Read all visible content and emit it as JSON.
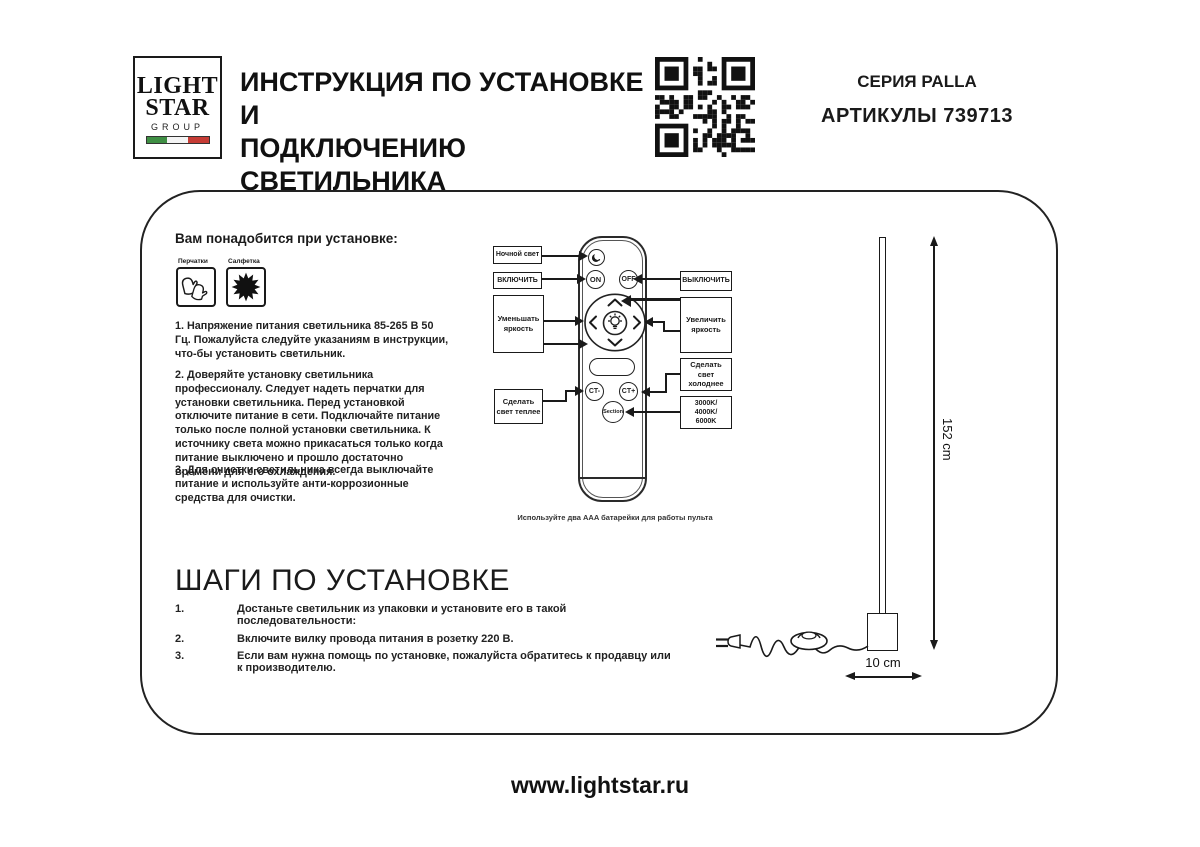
{
  "header": {
    "logo": {
      "word1": "LIGHT",
      "word2": "STAR",
      "word3": "GROUP"
    },
    "title_line1": "ИНСТРУКЦИЯ ПО УСТАНОВКЕ И",
    "title_line2": "ПОДКЛЮЧЕНИЮ СВЕТИЛЬНИКА",
    "series": "СЕРИЯ PALLA",
    "article": "АРТИКУЛЫ 739713"
  },
  "colors": {
    "ink": "#1a1a1a",
    "flag_green": "#3f8f44",
    "flag_white": "#f4f4f4",
    "flag_red": "#c63c35"
  },
  "requirements": {
    "heading": "Вам понадобится при установке:",
    "items": [
      {
        "label": "Перчатки",
        "icon": "gloves-icon"
      },
      {
        "label": "Салфетка",
        "icon": "napkin-icon"
      }
    ]
  },
  "notes": [
    "1. Напряжение питания светильника 85-265 В 50 Гц. Пожалуйста следуйте указаниям в инструкции, что-бы установить светильник.",
    "2. Доверяйте установку светильника профессионалу. Следует надеть перчатки для установки светильника. Перед установкой отключите питание в сети. Подключайте питание только после полной установки светильника. К источнику света можно прикасаться только когда питание выключено и прошло достаточно времени для его охлаждения.",
    "3. Для очистки светильника всегда выключайте питание и используйте анти-коррозионные средства для очистки."
  ],
  "remote": {
    "buttons": {
      "night_icon": "moon-icon",
      "on": "ON",
      "off": "OFF",
      "center_icon": "bulb-icon",
      "ct_minus": "CT-",
      "ct_plus": "CT+",
      "section": "Section"
    },
    "labels": {
      "night": "Ночной свет",
      "turn_on": "ВКЛЮЧИТЬ",
      "turn_off": "ВЫКЛЮЧИТЬ",
      "dim": "Уменьшать яркость",
      "brighten": "Увеличить яркость",
      "cooler": "Сделать свет холоднее",
      "warmer": "Сделать свет теплее",
      "kelvin": "3000K/\n4000K/\n6000K"
    },
    "battery_note": "Используйте два AAA батарейки для работы пульта"
  },
  "steps": {
    "heading": "ШАГИ ПО УСТАНОВКЕ",
    "items": [
      {
        "num": "1.",
        "text": "Достаньте светильник из упаковки и установите его в такой последовательности:"
      },
      {
        "num": "2.",
        "text": "Включите вилку провода питания в розетку 220 В."
      },
      {
        "num": "3.",
        "text": "Если вам нужна помощь по установке, пожалуйста обратитесь к продавцу или к производителю."
      }
    ]
  },
  "lamp": {
    "height_dim": "152 cm",
    "width_dim": "10 cm"
  },
  "footer": {
    "url": "www.lightstar.ru"
  }
}
